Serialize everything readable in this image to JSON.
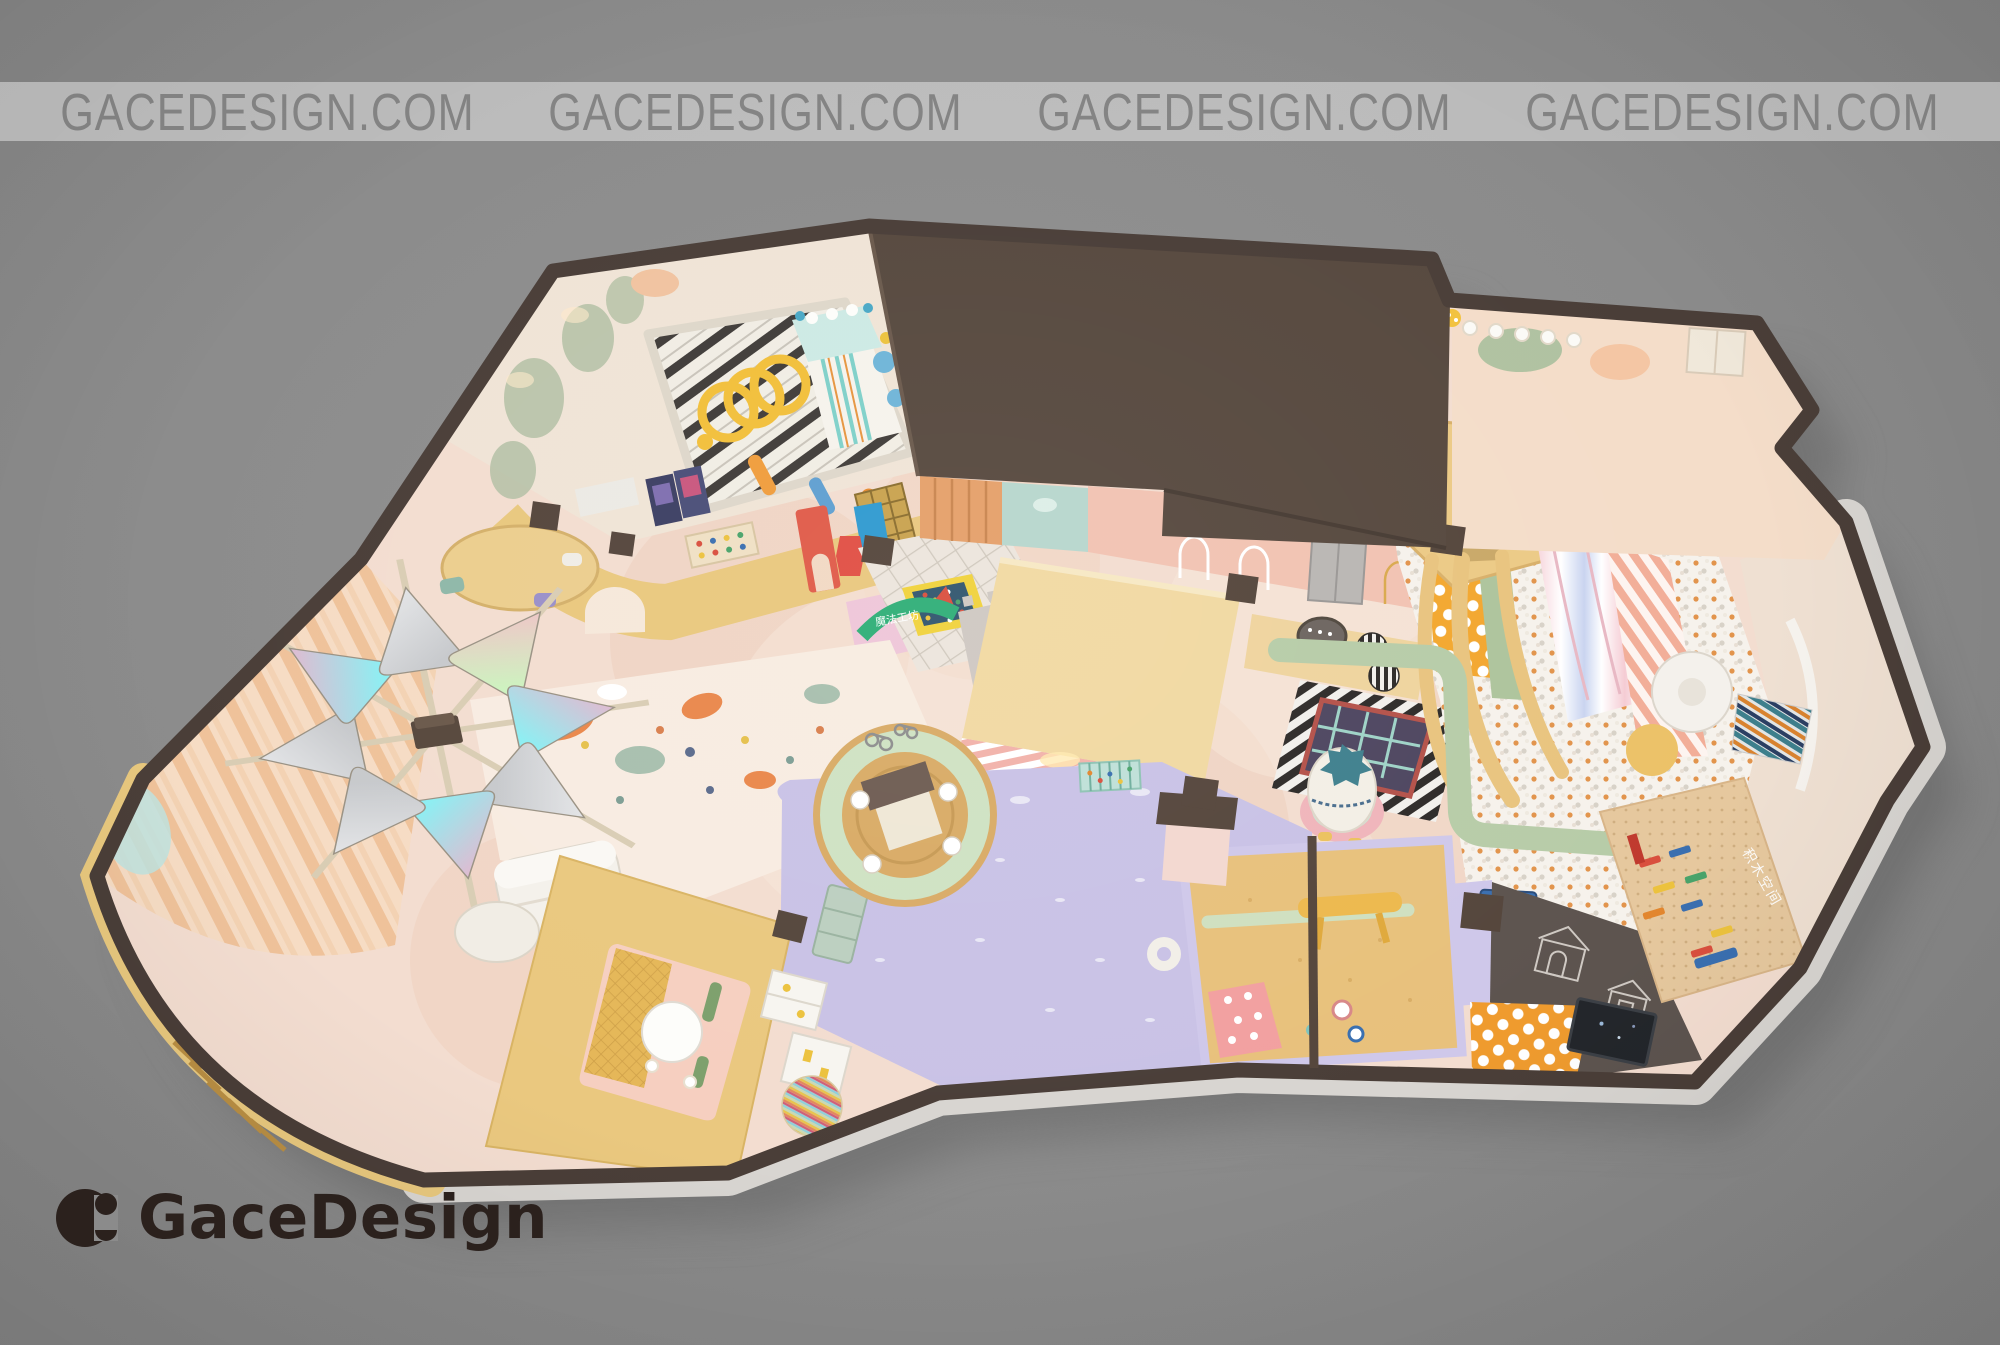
{
  "watermark": {
    "items": [
      "GACEDESIGN.COM",
      "GACEDESIGN.COM",
      "GACEDESIGN.COM",
      "GACEDESIGN.COM"
    ]
  },
  "logo": {
    "text": "GaceDesign"
  },
  "scene": {
    "type": "3d-top-view-interior-render",
    "subject": "children's indoor playground floor plan",
    "signs": {
      "ball_pit": "超级球池区",
      "workshop_arch": "魔法工坊",
      "blocks_room": "积木空间"
    }
  },
  "palette": {
    "background": "#8b8b8b",
    "watermark_band": "rgba(255,255,255,0.42)",
    "watermark_text": "rgba(85,85,85,0.55)",
    "logo_ink": "#2b211d",
    "floor_base": "#f3ddd0",
    "wall_dark": "#4a3e38",
    "wall_light": "#d8d5d1",
    "wall_gold": "#e8c87e",
    "roof": "#57493f",
    "room_cream": "#f0e4d6",
    "lavender": "#c9c2e6",
    "sand": "#e8c17c",
    "counter_cream": "#f1d9a2",
    "kiosk_yellow": "#eac87f",
    "sage": "#b7cca8",
    "mint_sign": "#9ed3c0",
    "pink_wall": "#f2c3b2",
    "house_dark": "#5d544f",
    "polka_orange": "#f3a72f"
  }
}
